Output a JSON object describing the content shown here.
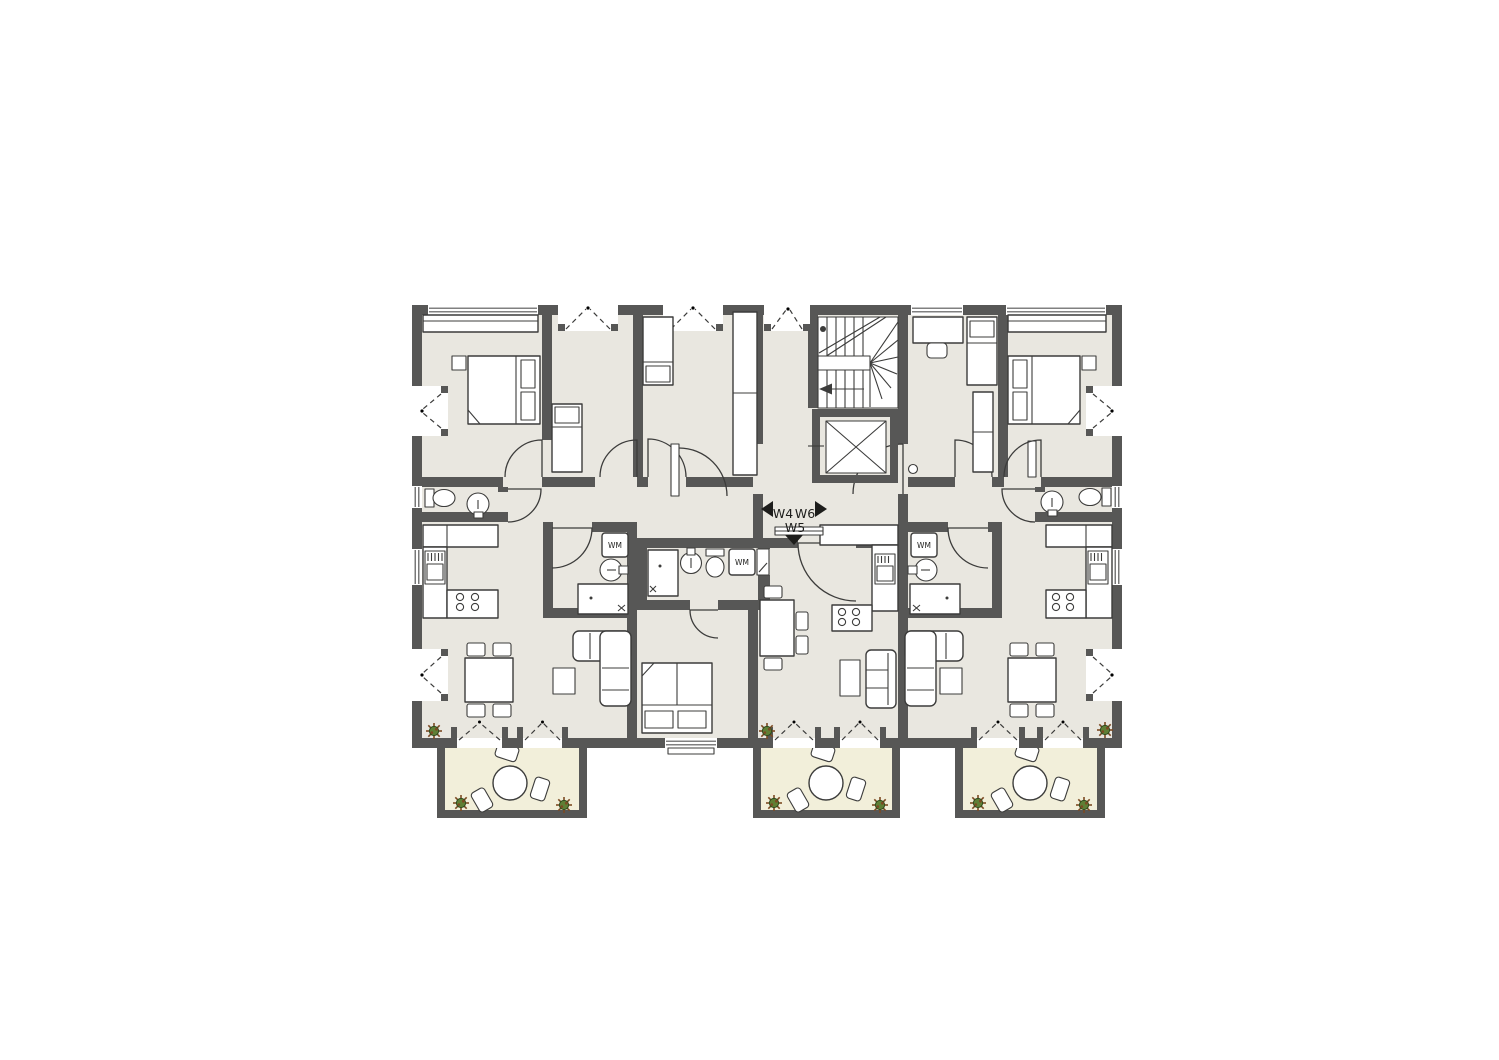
{
  "floor_plan": {
    "type": "apartment-floor-plan",
    "units": [
      {
        "id": "w4",
        "label": "W4",
        "arrow": "left"
      },
      {
        "id": "w5",
        "label": "W5",
        "arrow": "down"
      },
      {
        "id": "w6",
        "label": "W6",
        "arrow": "right"
      }
    ],
    "appliances": {
      "washing_machine_label": "WM"
    },
    "colors": {
      "wall": "#575756",
      "floor": "#e9e7e0",
      "balcony_floor": "#f2efda",
      "line": "#3c3c3b",
      "furniture_fill": "#ffffff",
      "plant_green": "#5f7f35",
      "plant_brown": "#7c4a22",
      "label_text": "#1d1d1b"
    }
  }
}
